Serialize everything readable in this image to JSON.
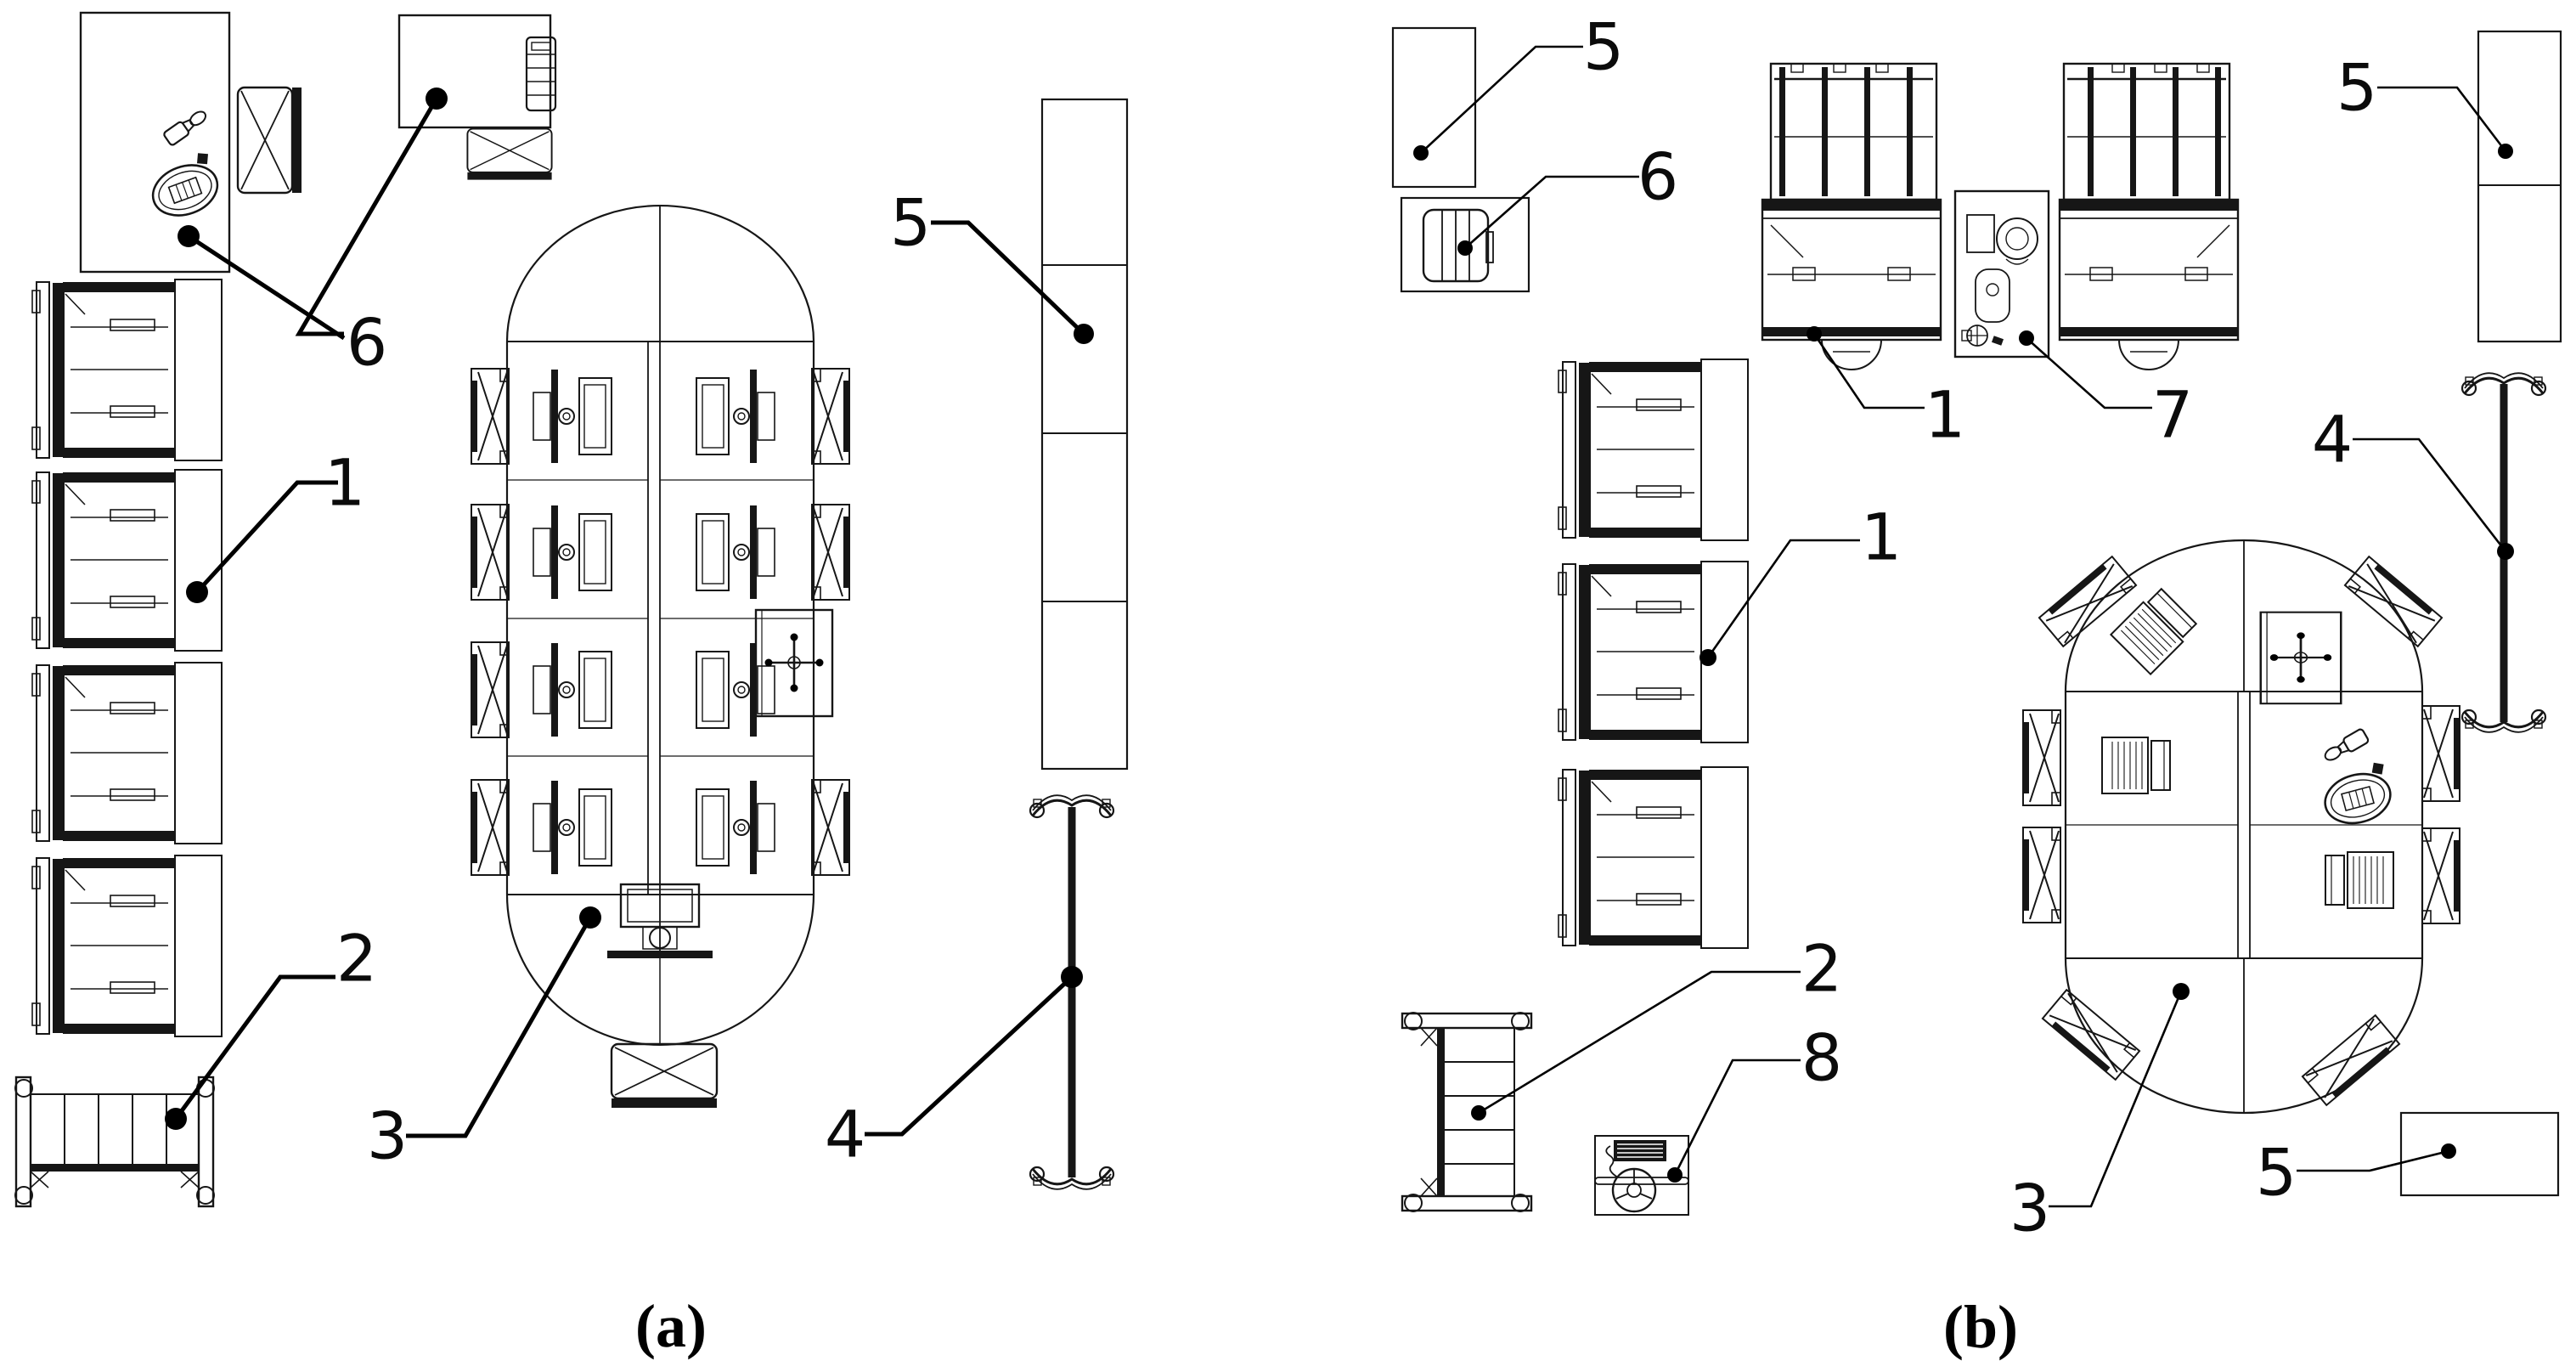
{
  "captions": {
    "panel_a": "(a)",
    "panel_b": "(b)"
  },
  "panel_a": {
    "callouts": {
      "bed_units": "1",
      "cot": "2",
      "oval_table": "3",
      "mobile_divider": "4",
      "tall_cabinet": "5",
      "staff_desks": "6"
    }
  },
  "panel_b": {
    "callouts": {
      "desk_units": "1",
      "bed_units": "1",
      "cot": "2",
      "oval_table": "3",
      "mobile_divider": "4",
      "cabinet_top_left": "5",
      "cabinet_top_right": "5",
      "cabinet_bottom_right": "5",
      "printer_cabinet": "6",
      "sanitary_unit": "7",
      "equipment_desk": "8"
    }
  }
}
